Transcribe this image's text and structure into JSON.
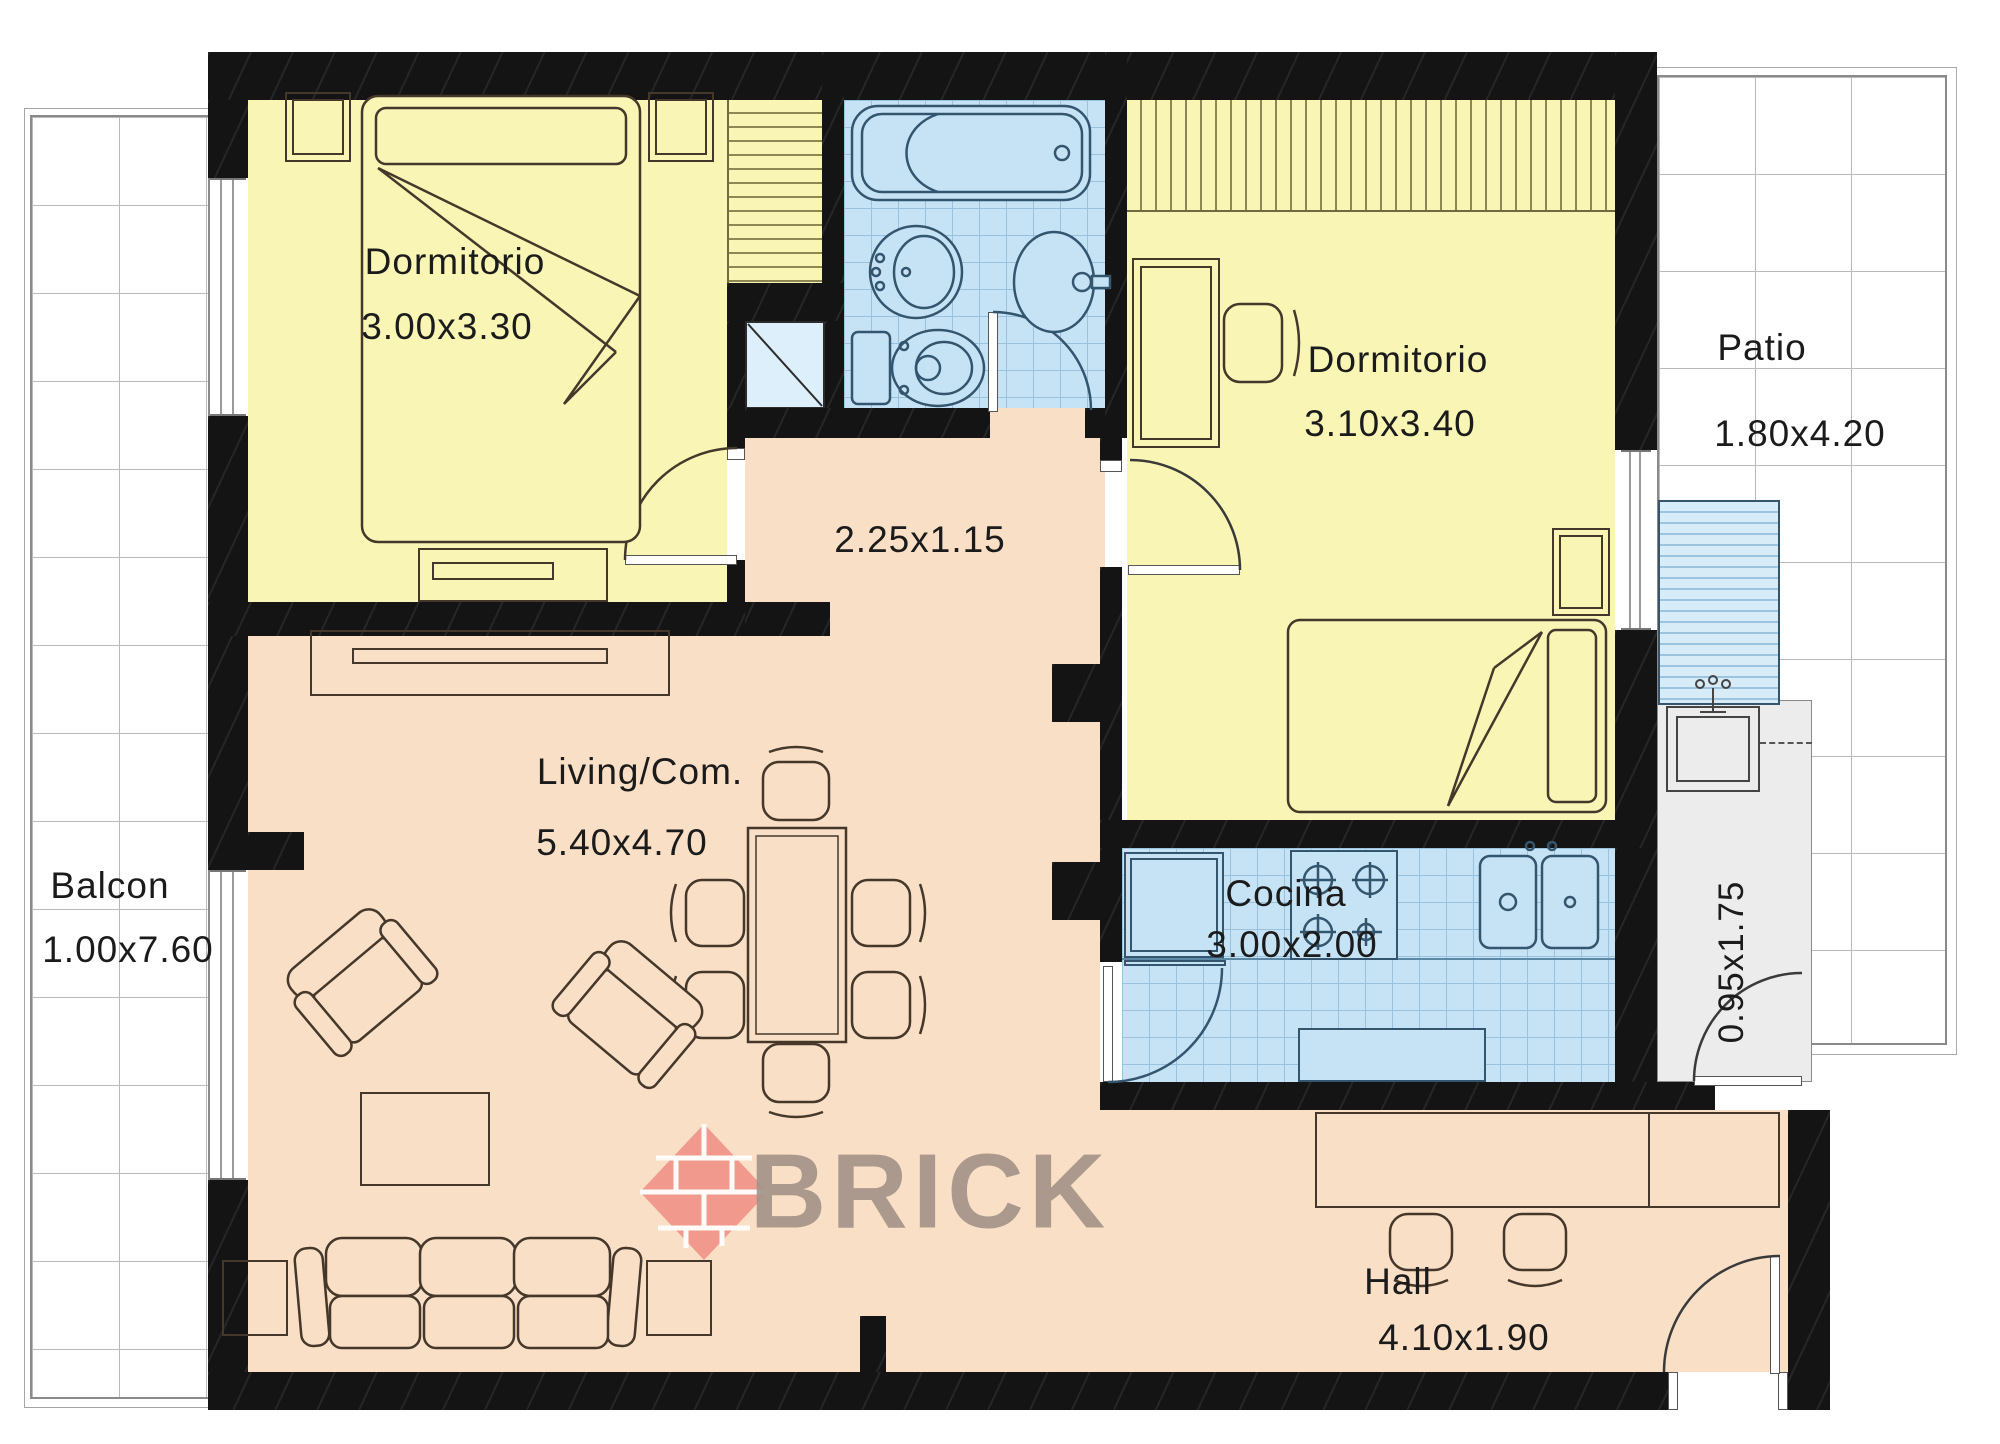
{
  "watermark": {
    "text": "BRICK",
    "text_color": "#A5948A",
    "diamond_color": "#F29289"
  },
  "rooms": {
    "dormitorio1": {
      "name": "Dormitorio",
      "dims": "3.00x3.30"
    },
    "dormitorio2": {
      "name": "Dormitorio",
      "dims": "3.10x3.40"
    },
    "patio": {
      "name": "Patio",
      "dims": "1.80x4.20"
    },
    "hallway": {
      "dims": "2.25x1.15"
    },
    "living": {
      "name": "Living/Com.",
      "dims": "5.40x4.70"
    },
    "cocina": {
      "name": "Cocina",
      "dims": "3.00x2.00"
    },
    "balcon": {
      "name": "Balcon",
      "dims": "1.00x7.60"
    },
    "hall": {
      "name": "Hall",
      "dims": "4.10x1.90"
    },
    "lavadero": {
      "dims": "0.95x1.75"
    }
  },
  "palette": {
    "wall": "#141414",
    "bedroom_floor": "#F8F5B5",
    "living_floor": "#F8DFC5",
    "wet_floor": "#C6E3F6",
    "tile_line": "#98C2DD",
    "laundry_floor": "#ECECEC",
    "ink": "#1b1b1b"
  }
}
